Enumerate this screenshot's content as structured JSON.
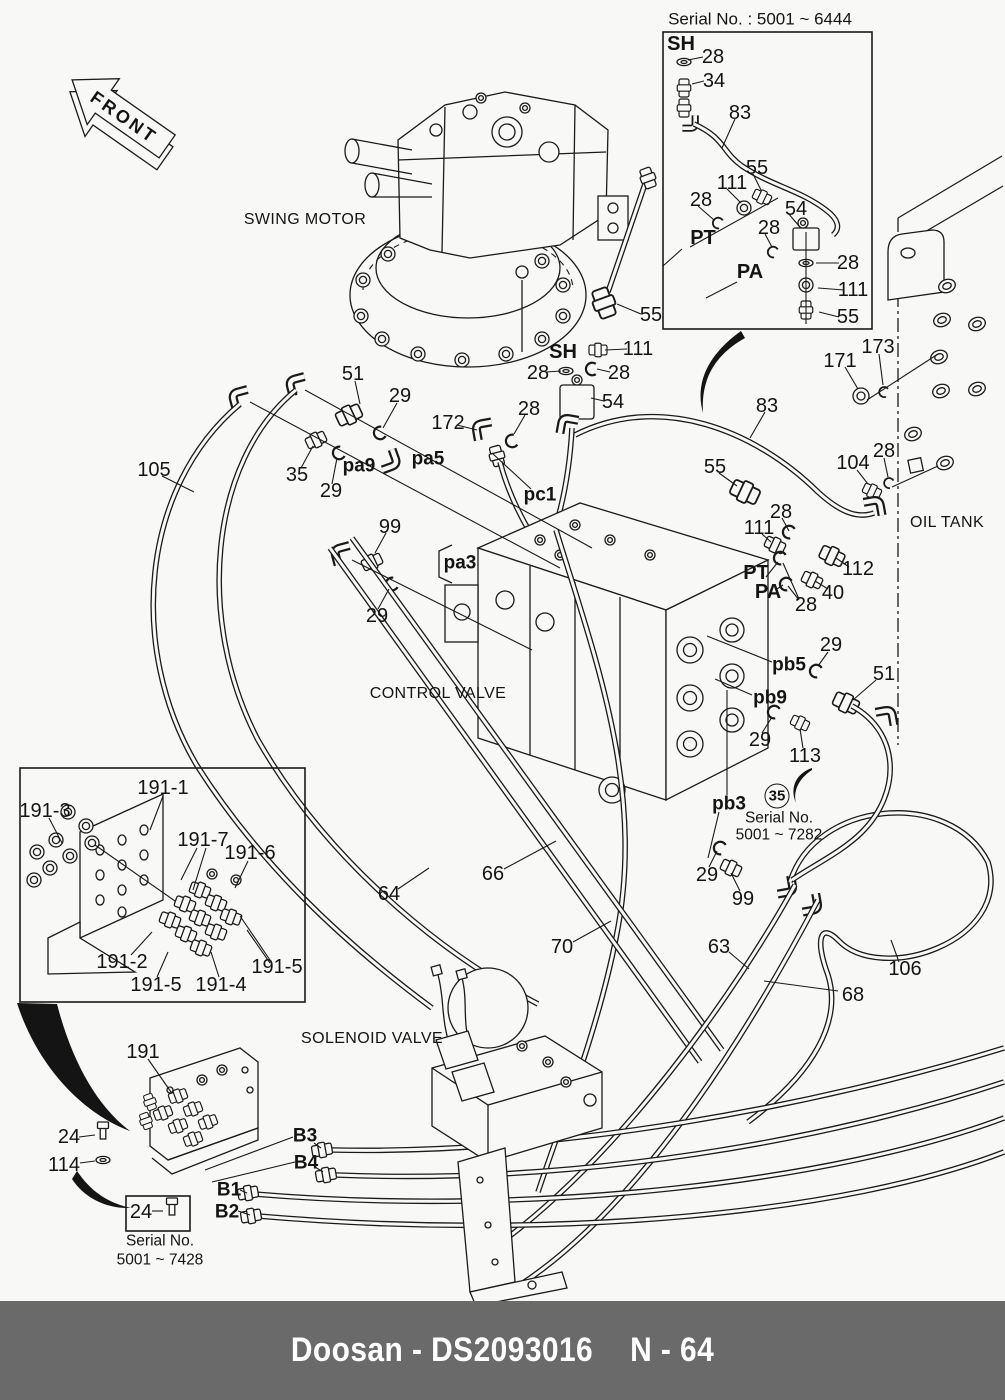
{
  "page": {
    "background": "#f8f8f7",
    "ink": "#1a1a1a"
  },
  "footer": {
    "left": "Doosan - DS2093016",
    "right": "N - 64",
    "bar_color": "#6a6a6a",
    "text_color": "#ffffff"
  },
  "front_arrow_label": "FRONT",
  "component_names": [
    "SWING MOTOR",
    "CONTROL VALVE",
    "OIL TANK",
    "SOLENOID VALVE"
  ],
  "serial_callouts": {
    "top_right_inset": "Serial No. : 5001 ~ 6444",
    "mid_right": {
      "badge": "35",
      "line1": "Serial No.",
      "line2": "5001 ~ 7282"
    },
    "bottom_left": {
      "badge": "24",
      "line1": "Serial No.",
      "line2": "5001 ~ 7428"
    }
  },
  "labels": [
    {
      "text": "Serial No. : 5001 ~ 6444",
      "x": 760,
      "y": 19,
      "kind": "t"
    },
    {
      "text": "SH",
      "x": 681,
      "y": 44,
      "kind": "B"
    },
    {
      "text": "28",
      "x": 713,
      "y": 57,
      "kind": "n"
    },
    {
      "text": "34",
      "x": 714,
      "y": 81,
      "kind": "n"
    },
    {
      "text": "83",
      "x": 740,
      "y": 113,
      "kind": "n"
    },
    {
      "text": "55",
      "x": 757,
      "y": 168,
      "kind": "n"
    },
    {
      "text": "111",
      "x": 732,
      "y": 183,
      "kind": "n"
    },
    {
      "text": "28",
      "x": 701,
      "y": 200,
      "kind": "n"
    },
    {
      "text": "PT",
      "x": 703,
      "y": 238,
      "kind": "B"
    },
    {
      "text": "54",
      "x": 796,
      "y": 209,
      "kind": "n"
    },
    {
      "text": "28",
      "x": 769,
      "y": 228,
      "kind": "n"
    },
    {
      "text": "PA",
      "x": 750,
      "y": 272,
      "kind": "B"
    },
    {
      "text": "28",
      "x": 848,
      "y": 263,
      "kind": "n"
    },
    {
      "text": "111",
      "x": 853,
      "y": 290,
      "kind": "n"
    },
    {
      "text": "55",
      "x": 848,
      "y": 317,
      "kind": "n"
    },
    {
      "text": "SWING MOTOR",
      "x": 305,
      "y": 220,
      "kind": "c"
    },
    {
      "text": "55",
      "x": 651,
      "y": 315,
      "kind": "n"
    },
    {
      "text": "SH",
      "x": 563,
      "y": 352,
      "kind": "B"
    },
    {
      "text": "111",
      "x": 638,
      "y": 349,
      "kind": "n"
    },
    {
      "text": "28",
      "x": 538,
      "y": 373,
      "kind": "n"
    },
    {
      "text": "28",
      "x": 619,
      "y": 373,
      "kind": "n"
    },
    {
      "text": "54",
      "x": 613,
      "y": 402,
      "kind": "n"
    },
    {
      "text": "172",
      "x": 448,
      "y": 423,
      "kind": "n"
    },
    {
      "text": "28",
      "x": 529,
      "y": 409,
      "kind": "n"
    },
    {
      "text": "pc1",
      "x": 540,
      "y": 495,
      "kind": "b"
    },
    {
      "text": "51",
      "x": 353,
      "y": 374,
      "kind": "n"
    },
    {
      "text": "29",
      "x": 400,
      "y": 396,
      "kind": "n"
    },
    {
      "text": "pa5",
      "x": 428,
      "y": 459,
      "kind": "b"
    },
    {
      "text": "pa9",
      "x": 359,
      "y": 466,
      "kind": "b"
    },
    {
      "text": "35",
      "x": 297,
      "y": 475,
      "kind": "n"
    },
    {
      "text": "29",
      "x": 331,
      "y": 491,
      "kind": "n"
    },
    {
      "text": "105",
      "x": 154,
      "y": 470,
      "kind": "n"
    },
    {
      "text": "99",
      "x": 390,
      "y": 527,
      "kind": "n"
    },
    {
      "text": "pa3",
      "x": 460,
      "y": 563,
      "kind": "b"
    },
    {
      "text": "29",
      "x": 377,
      "y": 616,
      "kind": "n"
    },
    {
      "text": "CONTROL VALVE",
      "x": 438,
      "y": 694,
      "kind": "c"
    },
    {
      "text": "OIL TANK",
      "x": 947,
      "y": 523,
      "kind": "c"
    },
    {
      "text": "171",
      "x": 840,
      "y": 361,
      "kind": "n"
    },
    {
      "text": "173",
      "x": 878,
      "y": 347,
      "kind": "n"
    },
    {
      "text": "104",
      "x": 853,
      "y": 463,
      "kind": "n"
    },
    {
      "text": "28",
      "x": 884,
      "y": 451,
      "kind": "n"
    },
    {
      "text": "83",
      "x": 767,
      "y": 406,
      "kind": "n"
    },
    {
      "text": "55",
      "x": 715,
      "y": 467,
      "kind": "n"
    },
    {
      "text": "28",
      "x": 781,
      "y": 512,
      "kind": "n"
    },
    {
      "text": "111",
      "x": 759,
      "y": 528,
      "kind": "n"
    },
    {
      "text": "PT",
      "x": 756,
      "y": 573,
      "kind": "B"
    },
    {
      "text": "PA",
      "x": 768,
      "y": 592,
      "kind": "B"
    },
    {
      "text": "28",
      "x": 806,
      "y": 605,
      "kind": "n"
    },
    {
      "text": "40",
      "x": 833,
      "y": 593,
      "kind": "n"
    },
    {
      "text": "112",
      "x": 858,
      "y": 569,
      "kind": "n"
    },
    {
      "text": "pb5",
      "x": 789,
      "y": 665,
      "kind": "b"
    },
    {
      "text": "29",
      "x": 831,
      "y": 645,
      "kind": "n"
    },
    {
      "text": "51",
      "x": 884,
      "y": 674,
      "kind": "n"
    },
    {
      "text": "pb9",
      "x": 770,
      "y": 698,
      "kind": "b"
    },
    {
      "text": "29",
      "x": 760,
      "y": 740,
      "kind": "n"
    },
    {
      "text": "113",
      "x": 805,
      "y": 756,
      "kind": "n"
    },
    {
      "text": "pb3",
      "x": 729,
      "y": 804,
      "kind": "b"
    },
    {
      "text": "35",
      "x": 777,
      "y": 796,
      "kind": "o"
    },
    {
      "text": "Serial No.",
      "x": 779,
      "y": 818,
      "kind": "s"
    },
    {
      "text": "5001 ~ 7282",
      "x": 779,
      "y": 835,
      "kind": "s"
    },
    {
      "text": "29",
      "x": 707,
      "y": 875,
      "kind": "n"
    },
    {
      "text": "99",
      "x": 743,
      "y": 899,
      "kind": "n"
    },
    {
      "text": "64",
      "x": 389,
      "y": 894,
      "kind": "n"
    },
    {
      "text": "66",
      "x": 493,
      "y": 874,
      "kind": "n"
    },
    {
      "text": "70",
      "x": 562,
      "y": 947,
      "kind": "n"
    },
    {
      "text": "63",
      "x": 719,
      "y": 947,
      "kind": "n"
    },
    {
      "text": "68",
      "x": 853,
      "y": 995,
      "kind": "n"
    },
    {
      "text": "106",
      "x": 905,
      "y": 969,
      "kind": "n"
    },
    {
      "text": "191-1",
      "x": 163,
      "y": 788,
      "kind": "n"
    },
    {
      "text": "191-3",
      "x": 45,
      "y": 811,
      "kind": "n"
    },
    {
      "text": "191-7",
      "x": 203,
      "y": 840,
      "kind": "n"
    },
    {
      "text": "191-6",
      "x": 250,
      "y": 853,
      "kind": "n"
    },
    {
      "text": "191-2",
      "x": 122,
      "y": 962,
      "kind": "n"
    },
    {
      "text": "191-5",
      "x": 156,
      "y": 985,
      "kind": "n"
    },
    {
      "text": "191-4",
      "x": 221,
      "y": 985,
      "kind": "n"
    },
    {
      "text": "191-5",
      "x": 277,
      "y": 967,
      "kind": "n"
    },
    {
      "text": "SOLENOID VALVE",
      "x": 372,
      "y": 1039,
      "kind": "c"
    },
    {
      "text": "191",
      "x": 143,
      "y": 1052,
      "kind": "n"
    },
    {
      "text": "24",
      "x": 69,
      "y": 1137,
      "kind": "n"
    },
    {
      "text": "114",
      "x": 64,
      "y": 1165,
      "kind": "n"
    },
    {
      "text": "B3",
      "x": 305,
      "y": 1136,
      "kind": "b"
    },
    {
      "text": "B4",
      "x": 306,
      "y": 1163,
      "kind": "b"
    },
    {
      "text": "B1",
      "x": 229,
      "y": 1190,
      "kind": "b"
    },
    {
      "text": "B2",
      "x": 227,
      "y": 1212,
      "kind": "b"
    },
    {
      "text": "24",
      "x": 141,
      "y": 1212,
      "kind": "n"
    },
    {
      "text": "Serial No.",
      "x": 160,
      "y": 1241,
      "kind": "s"
    },
    {
      "text": "5001 ~ 7428",
      "x": 160,
      "y": 1260,
      "kind": "s"
    }
  ]
}
